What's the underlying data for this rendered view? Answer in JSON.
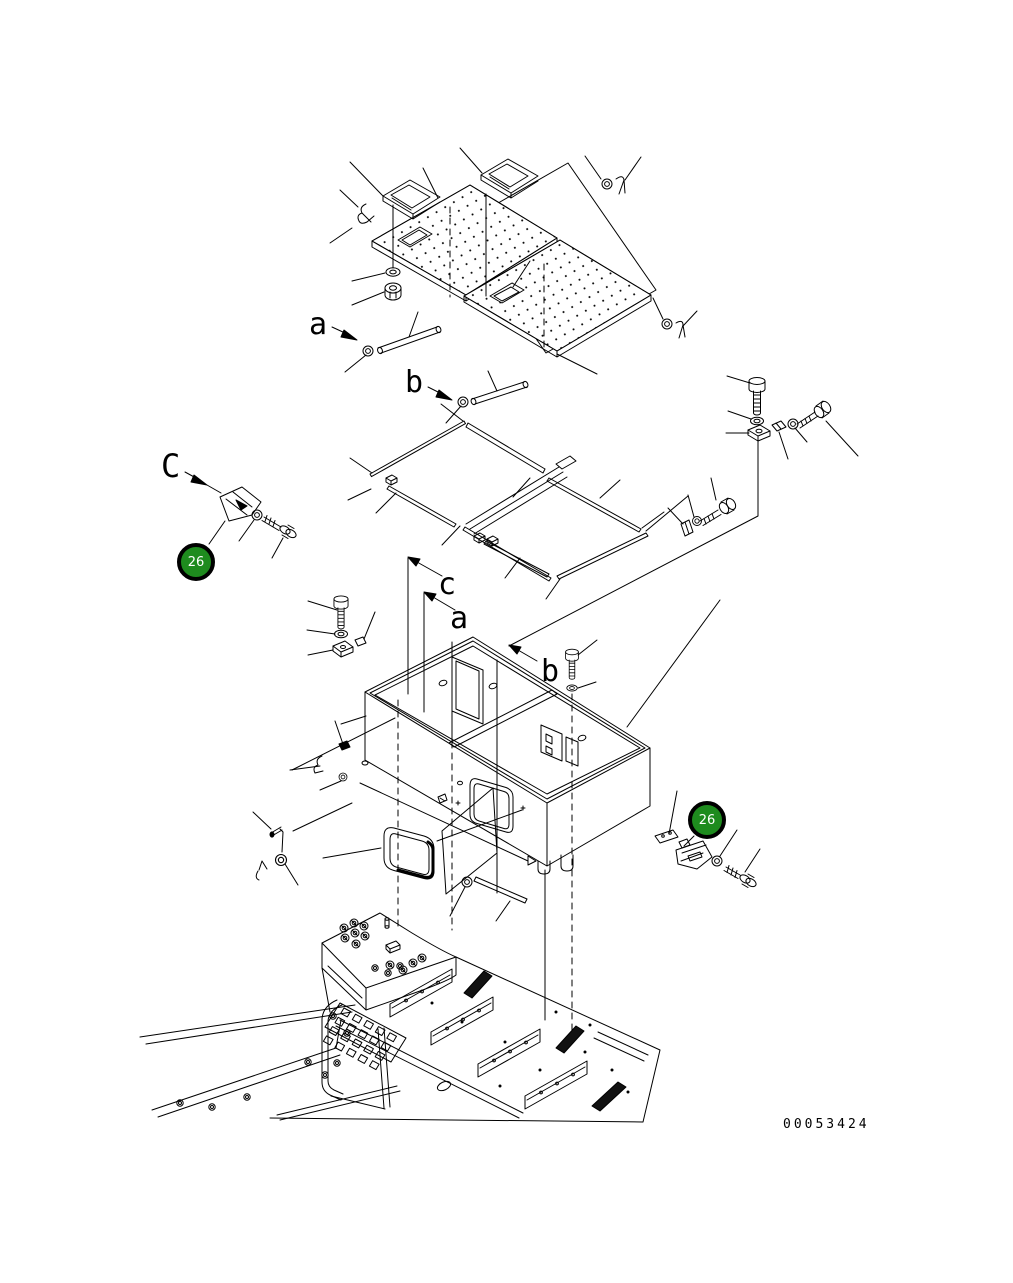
{
  "document": {
    "type": "exploded-parts-diagram",
    "background": "#ffffff",
    "line_color": "#000000"
  },
  "view_labels": {
    "top_a": "a",
    "top_b": "b",
    "left_C": "C",
    "mid_c": "c",
    "mid_a": "a",
    "mid_b": "b"
  },
  "callouts": {
    "badge_left": "26",
    "badge_right": "26",
    "badge_color": "#1e8b1e",
    "badge_ring_color": "#000000",
    "badge_text_color": "#ffffff"
  },
  "drawing_number": "00053424"
}
